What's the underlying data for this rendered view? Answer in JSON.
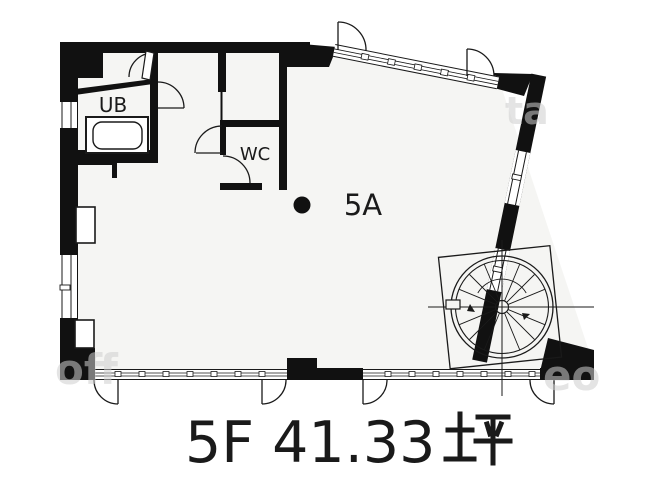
{
  "plan": {
    "rooms": {
      "ub": "UB",
      "wc": "WC",
      "unit": "5A"
    },
    "caption": {
      "text": "5F 41.33坪",
      "latin": "5F 41.33",
      "unit_glyph": "坪"
    },
    "watermarks": {
      "top_right": "ta",
      "bottom_left": "off",
      "bottom_right": "eo"
    },
    "features": {
      "bathtub": "bathtub",
      "spiral_stair": "spiral-staircase",
      "point_marker": "black-dot"
    },
    "colors": {
      "wall": "#111111",
      "floor": "#f5f5f3",
      "line": "#1a1a1a",
      "watermark": "#cfcfcf",
      "background": "#ffffff"
    }
  }
}
